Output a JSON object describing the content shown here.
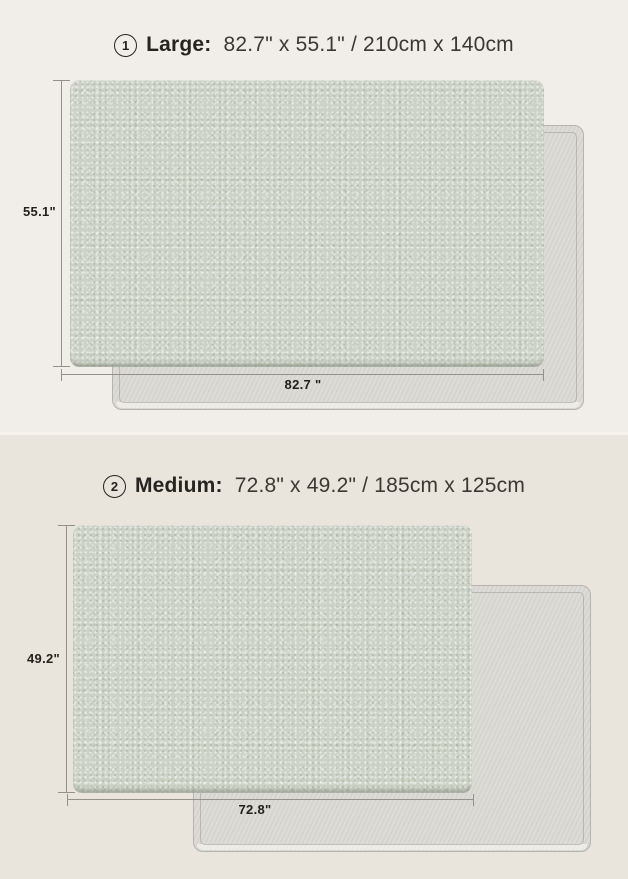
{
  "colors": {
    "bg-top": "#f1eee9",
    "bg-bottom": "#e9e5dd",
    "divider": "#f7f4ee",
    "mat-front": "#cdd2c7",
    "mat-back": "#dbd9d4",
    "mat-back-border": "#b7b4ae",
    "dim-line": "#94908a",
    "text-title": "#262420",
    "text-dims": "#3b3832",
    "text-label": "#23211c"
  },
  "sections": [
    {
      "badge_number": "1",
      "name_label": "Large:",
      "dimensions_text": "82.7\" x 55.1\" / 210cm x 140cm",
      "height_label": "55.1\"",
      "width_label": "82.7 \""
    },
    {
      "badge_number": "2",
      "name_label": "Medium:",
      "dimensions_text": "72.8\" x 49.2\" / 185cm x 125cm",
      "height_label": "49.2\"",
      "width_label": "72.8\""
    }
  ]
}
